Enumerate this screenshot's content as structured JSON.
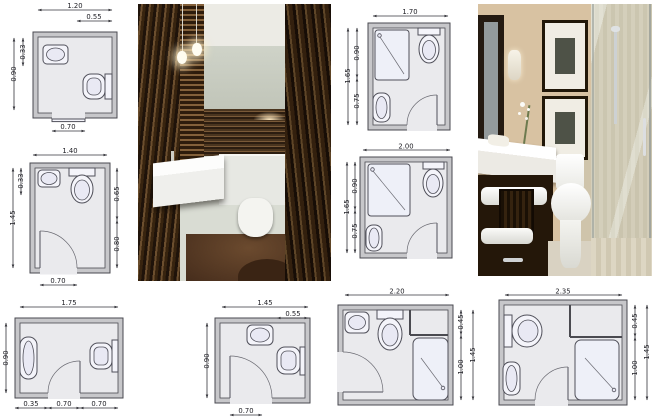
{
  "title": "small bathroom layout plans collage",
  "colors": {
    "plan_wall_fill": "#c7c7ca",
    "plan_line": "#4a4a50",
    "dim_line": "#35353b",
    "wood_dark": "#2a1a0c",
    "wood_mid": "#6b4e2e",
    "beige_wall": "#d6c1a1",
    "vanity_dark": "#241709"
  },
  "plans": [
    {
      "name": "plan-1",
      "dims": {
        "width": "1.20",
        "width_inner": "0.55",
        "left_inner": "0.33",
        "depth": "0.90",
        "door": "0.70"
      }
    },
    {
      "name": "plan-2",
      "dims": {
        "width": "1.40",
        "left_inner": "0.33",
        "depth": "1.45",
        "right_upper": "0.65",
        "right_lower": "0.80",
        "door": "0.70"
      }
    },
    {
      "name": "plan-3",
      "dims": {
        "width": "1.75",
        "depth": "0.90",
        "bottom_a": "0.35",
        "bottom_b": "0.70",
        "bottom_c": "0.70"
      }
    },
    {
      "name": "plan-4",
      "dims": {
        "width": "1.45",
        "width_inner": "0.55",
        "depth": "0.90",
        "door": "0.70"
      }
    },
    {
      "name": "plan-5",
      "dims": {
        "width": "1.70",
        "left_upper": "0.90",
        "depth": "1.65",
        "left_lower": "0.75"
      }
    },
    {
      "name": "plan-6",
      "dims": {
        "width": "2.00",
        "left_upper": "0.90",
        "depth": "1.65",
        "left_lower": "0.75"
      }
    },
    {
      "name": "plan-7",
      "dims": {
        "width": "2.20",
        "right_upper": "0.45",
        "depth": "1.45",
        "right_lower": "1.00"
      }
    },
    {
      "name": "plan-8",
      "dims": {
        "width": "2.35",
        "right_upper": "0.45",
        "depth": "1.45",
        "right_lower": "1.00"
      }
    }
  ]
}
